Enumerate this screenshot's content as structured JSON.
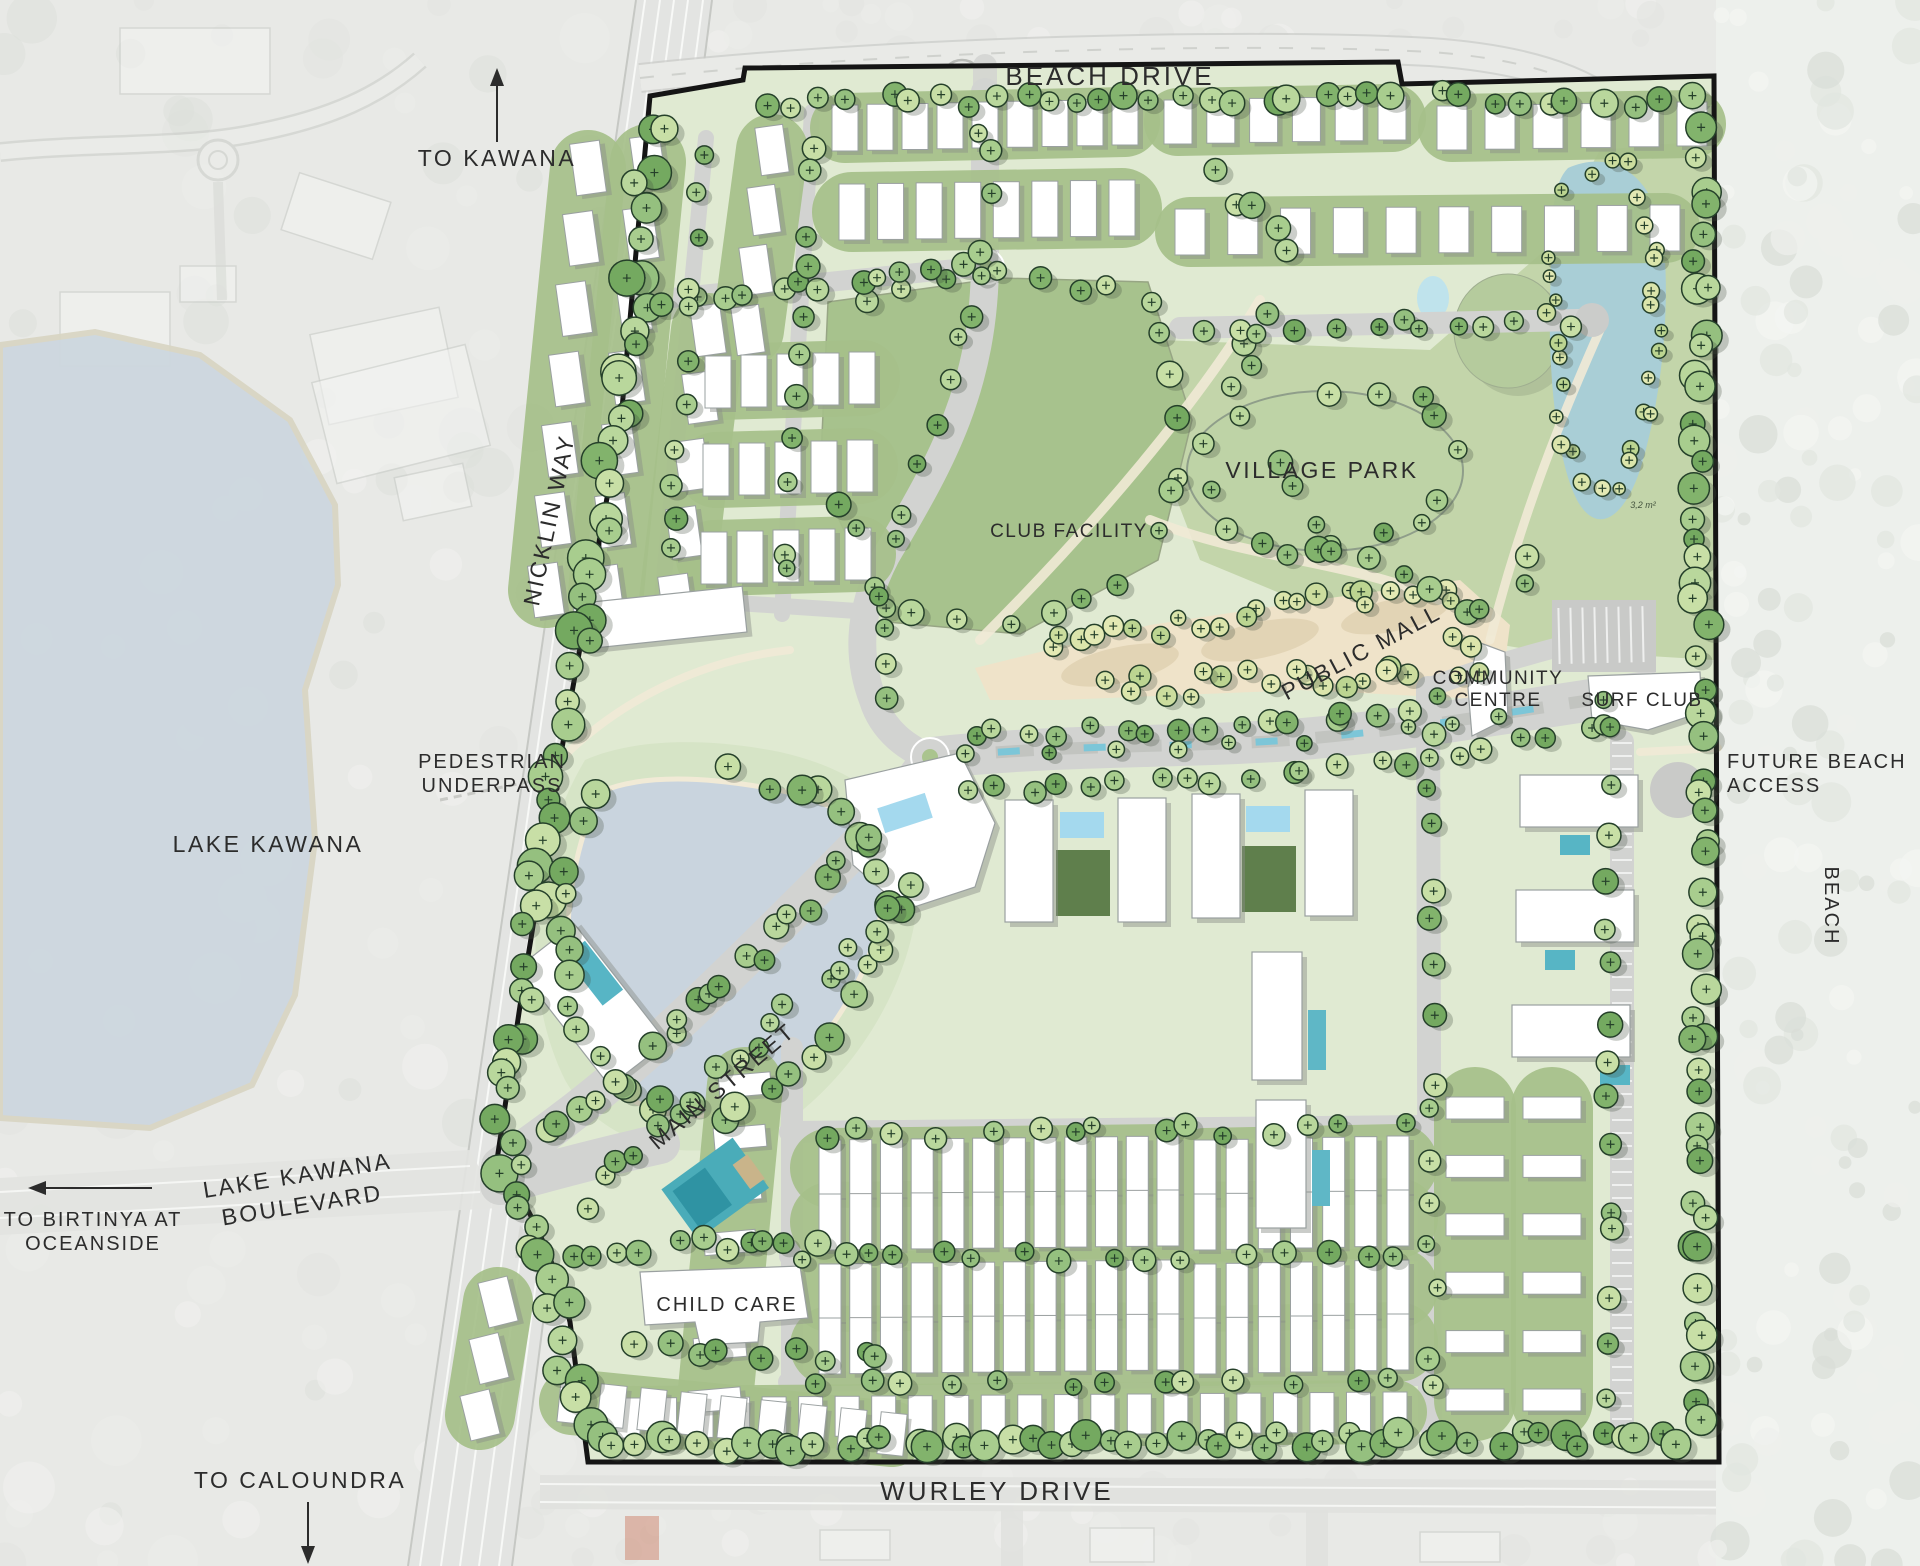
{
  "roads": {
    "beach_drive": "BEACH DRIVE",
    "nicklin_way": "NICKLIN WAY",
    "main_street": "MAIN STREET",
    "wurley_drive": "WURLEY DRIVE",
    "lake_kawana_boulevard_line1": "LAKE KAWANA",
    "lake_kawana_boulevard_line2": "BOULEVARD"
  },
  "places": {
    "lake_kawana": "LAKE KAWANA",
    "beach": "BEACH",
    "village_park": "VILLAGE PARK",
    "club_facility": "CLUB FACILITY",
    "public_mall": "PUBLIC MALL",
    "community_centre_line1": "COMMUNITY",
    "community_centre_line2": "CENTRE",
    "surf_club": "SURF CLUB",
    "child_care": "CHILD CARE",
    "pedestrian_underpass_line1": "PEDESTRIAN",
    "pedestrian_underpass_line2": "UNDERPASS",
    "future_beach_access_line1": "FUTURE BEACH",
    "future_beach_access_line2": "ACCESS"
  },
  "directions": {
    "to_kawana": "TO KAWANA",
    "to_caloundra": "TO CALOUNDRA",
    "to_birtinya_line1": "TO BIRTINYA AT",
    "to_birtinya_line2": "OCEANSIDE"
  },
  "annotations": {
    "area_label": "3,2 m²"
  },
  "colors": {
    "boundary": "#151515",
    "site_base": "#e0ead2",
    "park_green": "#c3d5aa",
    "club_green": "#a7c28d",
    "village_green": "#bed3a6",
    "mall_tan": "#efe3c9",
    "pond_blue": "#c9d4de",
    "lagoon_blue": "#a9ced6",
    "pool_blue": "#a4d9ee",
    "wetland_teal": "#4aacb9",
    "road_gray": "#d2d3d1",
    "lake_gray_blue": "#cdd7df",
    "building_white": "#ffffff",
    "aerial_gray": "#e8e9e6",
    "text_dark": "#2c2c2c"
  }
}
